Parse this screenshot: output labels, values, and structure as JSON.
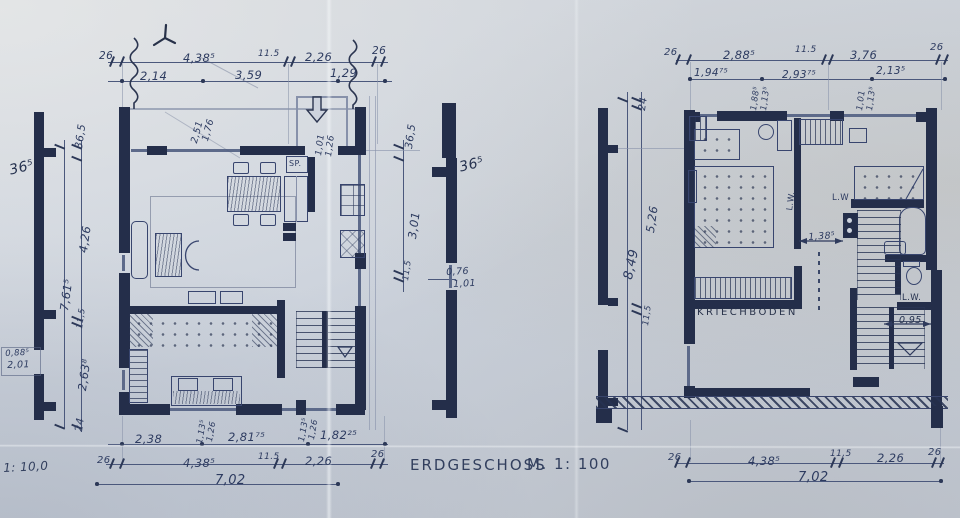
{
  "drawing": {
    "title": "ERDGESCHOSS",
    "scale": "M. 1: 100",
    "corner_note": "1: 10,0"
  },
  "left_plan": {
    "top_row1": [
      "26",
      "4,38⁵",
      "11.5",
      "2,26",
      "26"
    ],
    "top_row2": [
      "2,14",
      "3,59",
      "1,29"
    ],
    "left_col": [
      "36,5",
      "4,26",
      "7,61⁵",
      "11,5",
      "2,63⁸",
      "24"
    ],
    "wall_label_left": "36⁵",
    "bay": [
      "0,88⁵",
      "2,01"
    ],
    "mid_col": [
      "36,5",
      "3,01",
      "11,5"
    ],
    "wall_label_right": "36⁵",
    "opening": [
      "0,76",
      "1,01"
    ],
    "entry_door": [
      "1,01",
      "1,26"
    ],
    "closet": [
      "2,51",
      "1,76"
    ],
    "sink": "SP.",
    "bottom_row1": [
      "2,38",
      "2,81⁷⁵",
      "1,82²⁵"
    ],
    "door_a": [
      "1,13⁵",
      "1,26"
    ],
    "door_b": [
      "1,13⁵",
      "1,26"
    ],
    "bottom_row2": [
      "26",
      "4,38⁵",
      "11.5",
      "2,26",
      "26"
    ],
    "total": "7,02"
  },
  "right_plan": {
    "top_row1": [
      "26",
      "2,88⁵",
      "11.5",
      "3,76",
      "26"
    ],
    "top_row2": [
      "1,94⁷⁵",
      "2,93⁷⁵",
      "2,13⁵"
    ],
    "door_a": [
      "1,88⁵",
      "1,13⁵"
    ],
    "door_b": [
      "1,01",
      "1,13⁵"
    ],
    "left_col": [
      "24",
      "5,26",
      "8,49",
      "11,5"
    ],
    "room": "KRIECHBODEN",
    "lw": [
      "L.W.",
      "L.W",
      "L.W."
    ],
    "stair_width": "0,95",
    "corridor": "1,38⁵",
    "bottom_row": [
      "26",
      "4,38⁵",
      "11,5",
      "2,26",
      "26"
    ],
    "total": "7,02"
  }
}
